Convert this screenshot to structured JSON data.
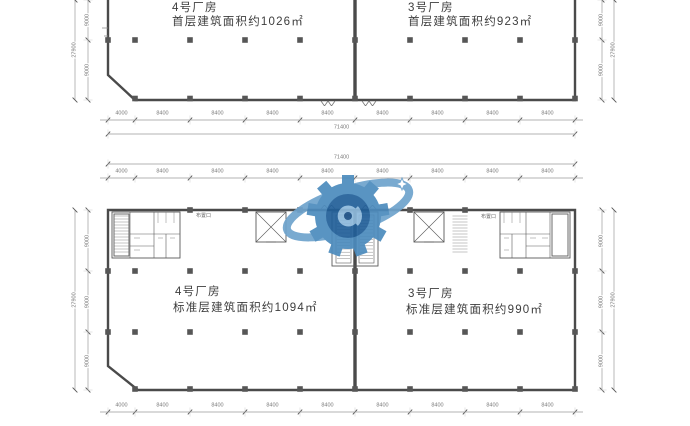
{
  "plans": [
    {
      "name": "first-floor",
      "units": [
        {
          "title": "4号厂房",
          "area_text": "首层建筑面积约1026㎡"
        },
        {
          "title": "3号厂房",
          "area_text": "首层建筑面积约923㎡"
        }
      ]
    },
    {
      "name": "standard-floor",
      "units": [
        {
          "title": "4号厂房",
          "area_text": "标准层建筑面积约1094㎡"
        },
        {
          "title": "3号厂房",
          "area_text": "标准层建筑面积约990㎡"
        }
      ]
    }
  ],
  "annotations": {
    "opening_label_left": "布置口",
    "opening_label_right": "布置口"
  },
  "dimensions": {
    "horizontal": {
      "segments": [
        "4000",
        "8400",
        "8400",
        "8400",
        "8400",
        "8400",
        "8400",
        "8400",
        "8400"
      ],
      "total": "71400"
    },
    "vertical": {
      "segments": [
        "9000",
        "9000",
        "9000"
      ],
      "total": "27900"
    }
  },
  "watermark": {
    "shape": "gear-orbit-logo",
    "primary": "#4c8bbd",
    "dark": "#215f99",
    "light": "#8db9dc"
  },
  "colors": {
    "wall": "#4a4a4a",
    "dimension_line": "#9a9a9a",
    "dimension_text": "#7a7a7a",
    "label_text": "#3d3d3d",
    "column": "#565656"
  }
}
